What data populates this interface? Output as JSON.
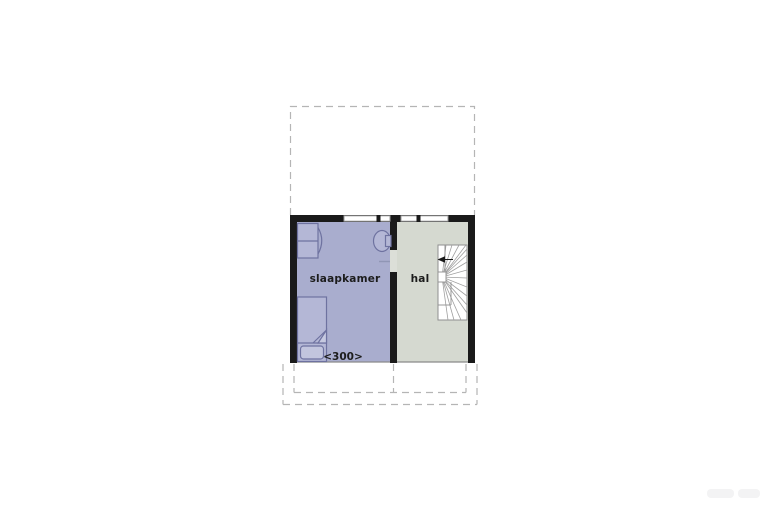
{
  "page": {
    "type": "floorplan",
    "background": "#ffffff"
  },
  "floorplan": {
    "rooms": [
      {
        "name": "slaapkamer",
        "label": "slaapkamer",
        "color": "#a9adce"
      },
      {
        "name": "hal",
        "label": "hal",
        "color": "#d5d9d0"
      }
    ],
    "dimension_label": "<300>",
    "stairs": {
      "type": "winder-staircase",
      "direction_icon": "up-arrow"
    },
    "furniture": [
      {
        "name": "bed"
      },
      {
        "name": "corner-wash-basin"
      },
      {
        "name": "wall-wash-basin"
      }
    ],
    "outlines": {
      "top_dashed_outline": "attic-floor-outline",
      "bottom_dashed_outline": "roof-slope-outline"
    },
    "colors": {
      "wall": "#1a1a1a",
      "dashed_outline": "#b5b5b5",
      "furniture_outline": "#6e72a0",
      "furniture_fill": "#b4b7d6",
      "stair_lines": "#9a9a9a",
      "floor_edge": "#8a8a8a"
    }
  }
}
